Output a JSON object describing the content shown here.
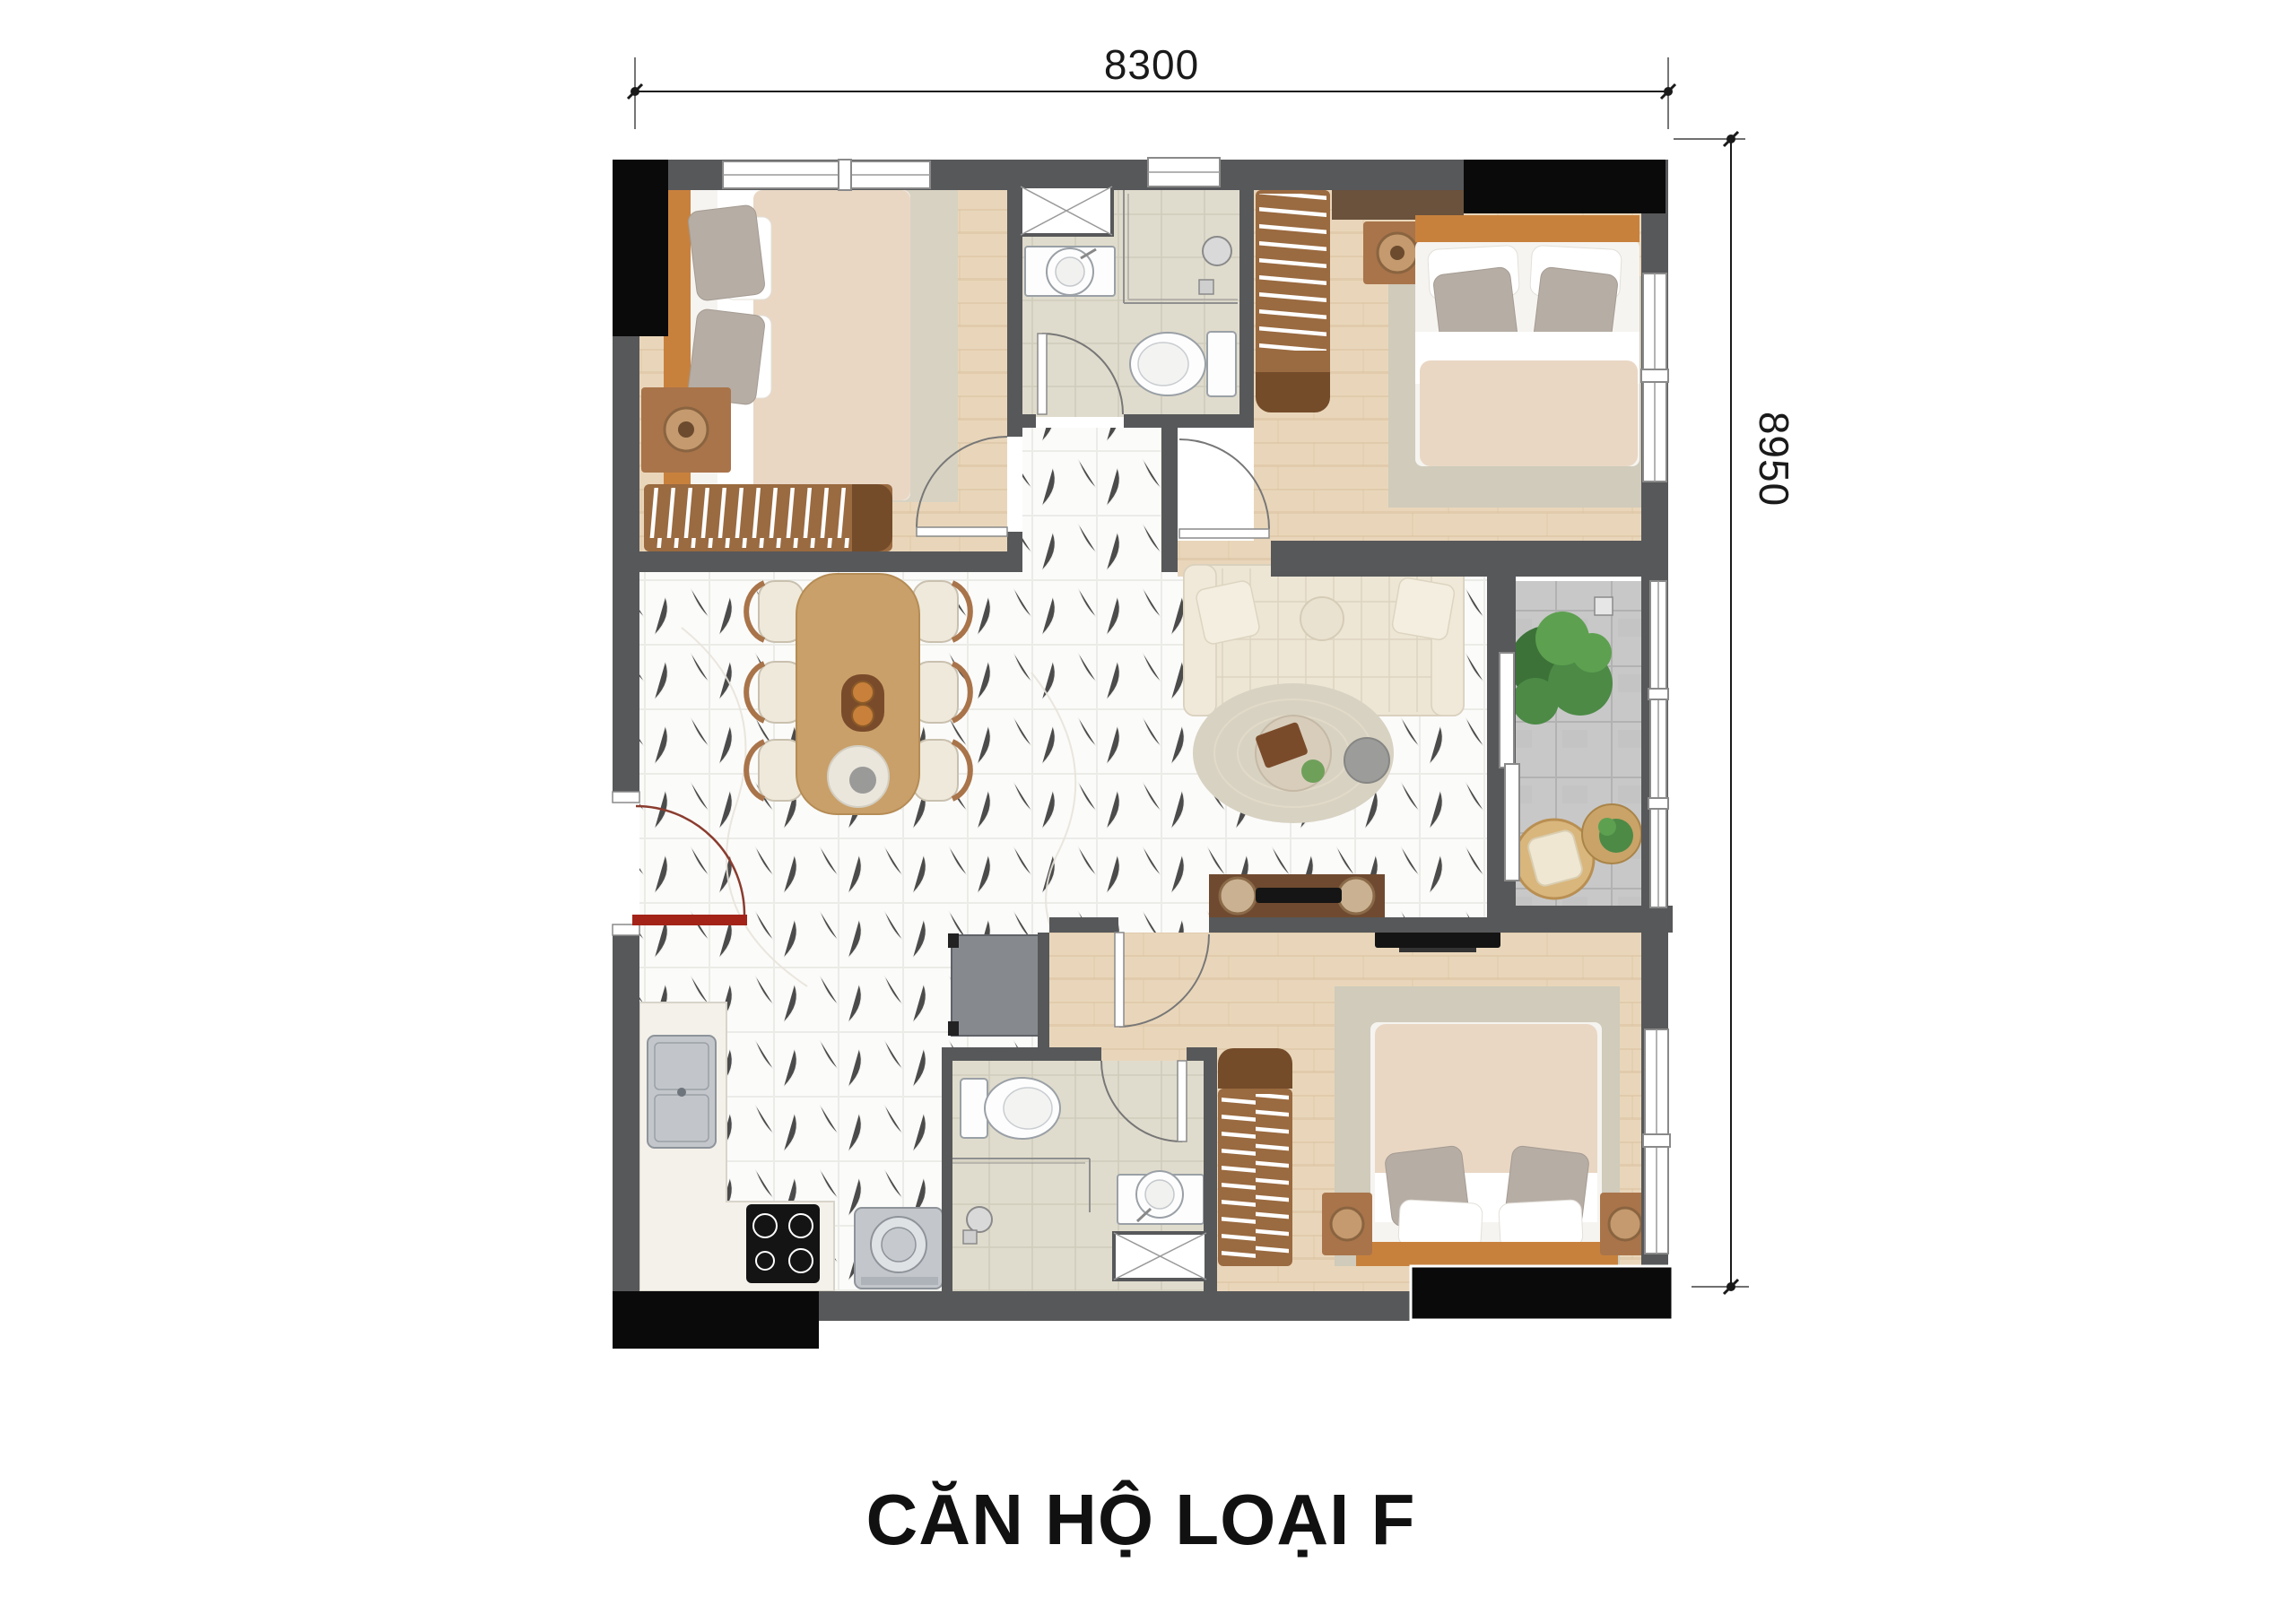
{
  "labels": {
    "title": "CĂN HỘ LOẠI F",
    "width_dim": "8300",
    "height_dim": "8950"
  },
  "colors": {
    "wall": "#57585a",
    "structure_black": "#0a0a0a",
    "wood_floor": "#e9d6ba",
    "wood_plank_line": "#d9c09c",
    "marble_floor": "#fbfbfa",
    "marble_grid": "#ebebe7",
    "bath_tile": "#e0dccd",
    "bath_tile_line": "#d0ccbc",
    "balcony_tile": "#c8c8c8",
    "balcony_tile_line": "#b2b2b2",
    "rug_beige": "#d8d2c2",
    "rug_gray": "#d0cbbb",
    "mattress": "#f6f4f0",
    "duvet": "#e9d7c4",
    "pillow_gray": "#b6ada5",
    "furniture_wood": "#a9744a",
    "bench_wood": "#9a6a40",
    "bench_cap": "#744c2a",
    "headboard_wood": "#c8813d",
    "table_wood": "#c9a069",
    "console_wood": "#6f4a30",
    "sofa_cream": "#ede6d5",
    "fixture_white": "#fdfdfd",
    "fixture_stroke": "#9aa0a6",
    "appliance_gray": "#c3c7cc",
    "fridge_gray": "#86898e",
    "plant_green": "#4c8a46",
    "rattan": "#d9b67c",
    "door_red": "#a32318",
    "dim_line": "#1a1a1a",
    "title_color": "#111111"
  },
  "plan": {
    "rooms": [
      {
        "id": "bedroom-1",
        "position": "top-left",
        "fixtures": [
          "double-bed",
          "nightstand-lamp",
          "slatted-bench",
          "area-rug",
          "wardrobe-shaft"
        ]
      },
      {
        "id": "bathroom-1",
        "position": "top-middle",
        "fixtures": [
          "washbasin",
          "toilet",
          "shower-corner",
          "technical-shaft-hatch"
        ]
      },
      {
        "id": "bedroom-2",
        "position": "top-right",
        "fixtures": [
          "double-bed",
          "nightstand-lamp",
          "slatted-bench",
          "wardrobe-shelf",
          "area-rug",
          "window"
        ]
      },
      {
        "id": "living-dining",
        "position": "center",
        "fixtures": [
          "dining-table-6-chairs",
          "sofa",
          "round-rug",
          "coffee-table",
          "side-table",
          "tv-console"
        ]
      },
      {
        "id": "kitchen",
        "position": "bottom-left",
        "fixtures": [
          "l-shaped-counter",
          "double-sink",
          "induction-hob",
          "washing-machine",
          "refrigerator",
          "entry-door"
        ]
      },
      {
        "id": "bathroom-2",
        "position": "bottom-middle",
        "fixtures": [
          "toilet",
          "shower-corner",
          "washbasin",
          "technical-shaft-hatch"
        ]
      },
      {
        "id": "bedroom-3",
        "position": "bottom-right",
        "fixtures": [
          "double-bed",
          "two-nightstands",
          "slatted-bench",
          "wall-tv",
          "area-rug",
          "window"
        ]
      },
      {
        "id": "balcony",
        "position": "right",
        "fixtures": [
          "monstera-plant",
          "floor-drain",
          "rattan-chair",
          "round-side-table",
          "sliding-glass-door"
        ]
      }
    ]
  }
}
